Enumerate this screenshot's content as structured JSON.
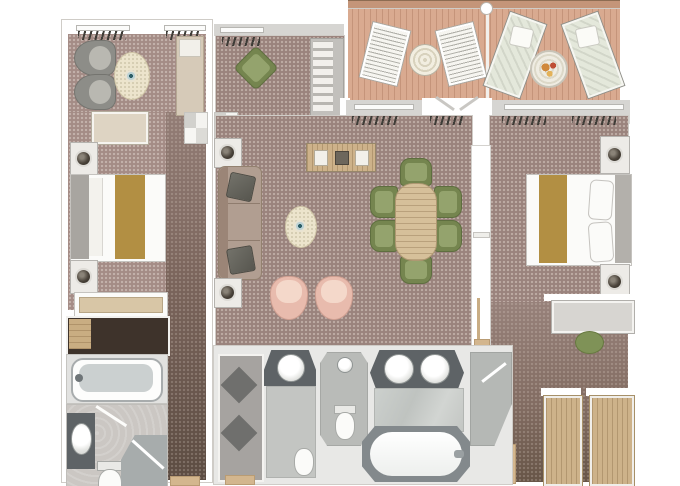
{
  "canvas": {
    "width": 680,
    "height": 486,
    "background": "#ffffff"
  },
  "scene": {
    "kind": "floor-plan",
    "content": "top-down rendered floor plan of a two-bedroom suite with private veranda",
    "visible_text": ""
  },
  "palette": {
    "background": "#ffffff",
    "wall_white": "#ffffff",
    "wall_gray_band": "#d6d5d2",
    "carpet_main": "#9a837d",
    "carpet_guest": "#a48c86",
    "carpet_corridor_dark": "#5c4c42",
    "deck_wood": "#d9aa90",
    "deck_rail": "#c49579",
    "bath_tile": "#c6c8c5",
    "marble": "#c8cbc8",
    "vanity_counter": "#5e6366",
    "closet_dark": "#3e332b",
    "closet_floor": "#a6a3a0",
    "wood_light": "#cdb28a",
    "gold_runner": "#b28f43",
    "olive_green": "#75854f",
    "blush_pink": "#e8bbad",
    "sofa_taupe": "#b19e91",
    "chair_gray": "#8d8d88",
    "rug_cream": "#ece4cc",
    "lounger_cushion": "#e4e8db",
    "entry_mat_tan": "#d3b68e"
  },
  "areas": [
    {
      "id": "veranda",
      "furniture": [
        "deck-chair",
        "deck-chair",
        "wicker-table",
        "sun-lounger",
        "sun-lounger",
        "refreshment-table"
      ]
    },
    {
      "id": "guest-bedroom",
      "furniture": [
        "armchair",
        "armchair",
        "oval-rug",
        "cocktail-table",
        "chaise-bench",
        "ottoman-bench",
        "nightstand-with-lamp",
        "double-bed-with-runner",
        "nightstand-with-lamp",
        "dresser",
        "dark-wardrobe-closet",
        "entry-mat"
      ]
    },
    {
      "id": "guest-bathroom",
      "furniture": [
        "bathtub",
        "washbasin",
        "toilet",
        "corner-shower"
      ]
    },
    {
      "id": "sitting-alcove",
      "furniture": [
        "lounge-chair",
        "shelving-unit"
      ]
    },
    {
      "id": "living-room",
      "furniture": [
        "sofa",
        "throw-pillow",
        "throw-pillow",
        "cabinet-with-lamp",
        "cabinet-with-lamp",
        "oval-rug",
        "cocktail-table",
        "tub-chair",
        "tub-chair",
        "console-sideboard"
      ]
    },
    {
      "id": "dining-area",
      "furniture": [
        "oval-dining-table",
        "dining-chair",
        "dining-chair",
        "dining-chair",
        "dining-chair",
        "dining-chair",
        "dining-chair"
      ]
    },
    {
      "id": "entry-foyer",
      "furniture": [
        "door",
        "door-mat"
      ]
    },
    {
      "id": "master-bedroom",
      "furniture": [
        "double-bed-with-runner",
        "pillow",
        "pillow",
        "nightstand-with-lamp",
        "nightstand-with-lamp",
        "desk",
        "stool"
      ]
    },
    {
      "id": "master-bathroom",
      "furniture": [
        "double-washbasin-vanity",
        "large-bathtub",
        "shower-enclosure",
        "toilet-room-basin",
        "toilet",
        "shower-room-basin",
        "shower-room-toilet"
      ]
    },
    {
      "id": "walk-in-closet",
      "furniture": [
        "diamond-inlay-floor",
        "entry-mat"
      ]
    },
    {
      "id": "wardrobe-corridor",
      "furniture": [
        "wardrobe",
        "wardrobe",
        "door"
      ]
    }
  ]
}
